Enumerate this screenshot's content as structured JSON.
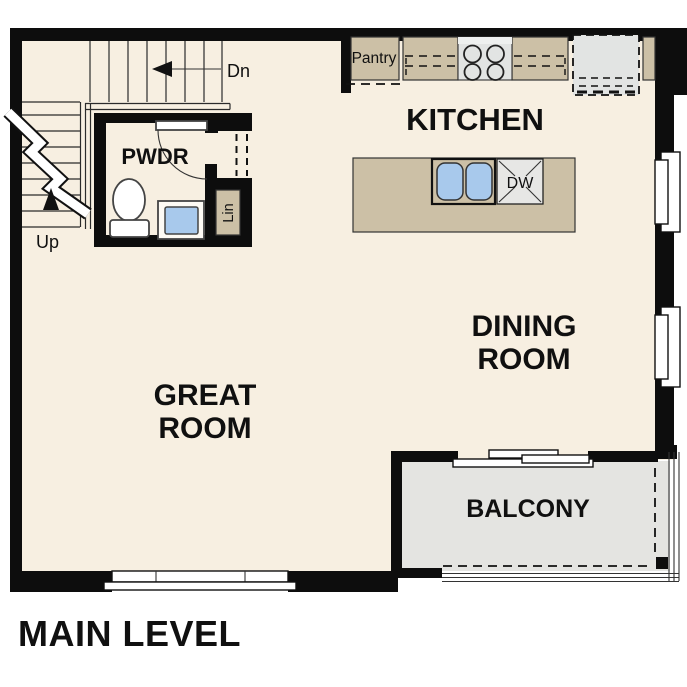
{
  "title": "MAIN LEVEL",
  "labels": {
    "main_level": "MAIN LEVEL",
    "kitchen": "KITCHEN",
    "dining_1": "DINING",
    "dining_2": "ROOM",
    "great_1": "GREAT",
    "great_2": "ROOM",
    "balcony": "BALCONY",
    "powder": "PWDR",
    "pantry": "Pantry",
    "linen": "Lin",
    "dishwasher": "DW",
    "stairs_down": "Dn",
    "stairs_up": "Up"
  },
  "colors": {
    "floor": "#f7efe1",
    "wall": "#0d0d0d",
    "counter": "#ccc0a6",
    "appliance": "#e2e4e3",
    "balcony": "#e4e4e1",
    "water_blue": "#a8c9ec",
    "window_white": "#ffffff",
    "text": "#101010"
  }
}
